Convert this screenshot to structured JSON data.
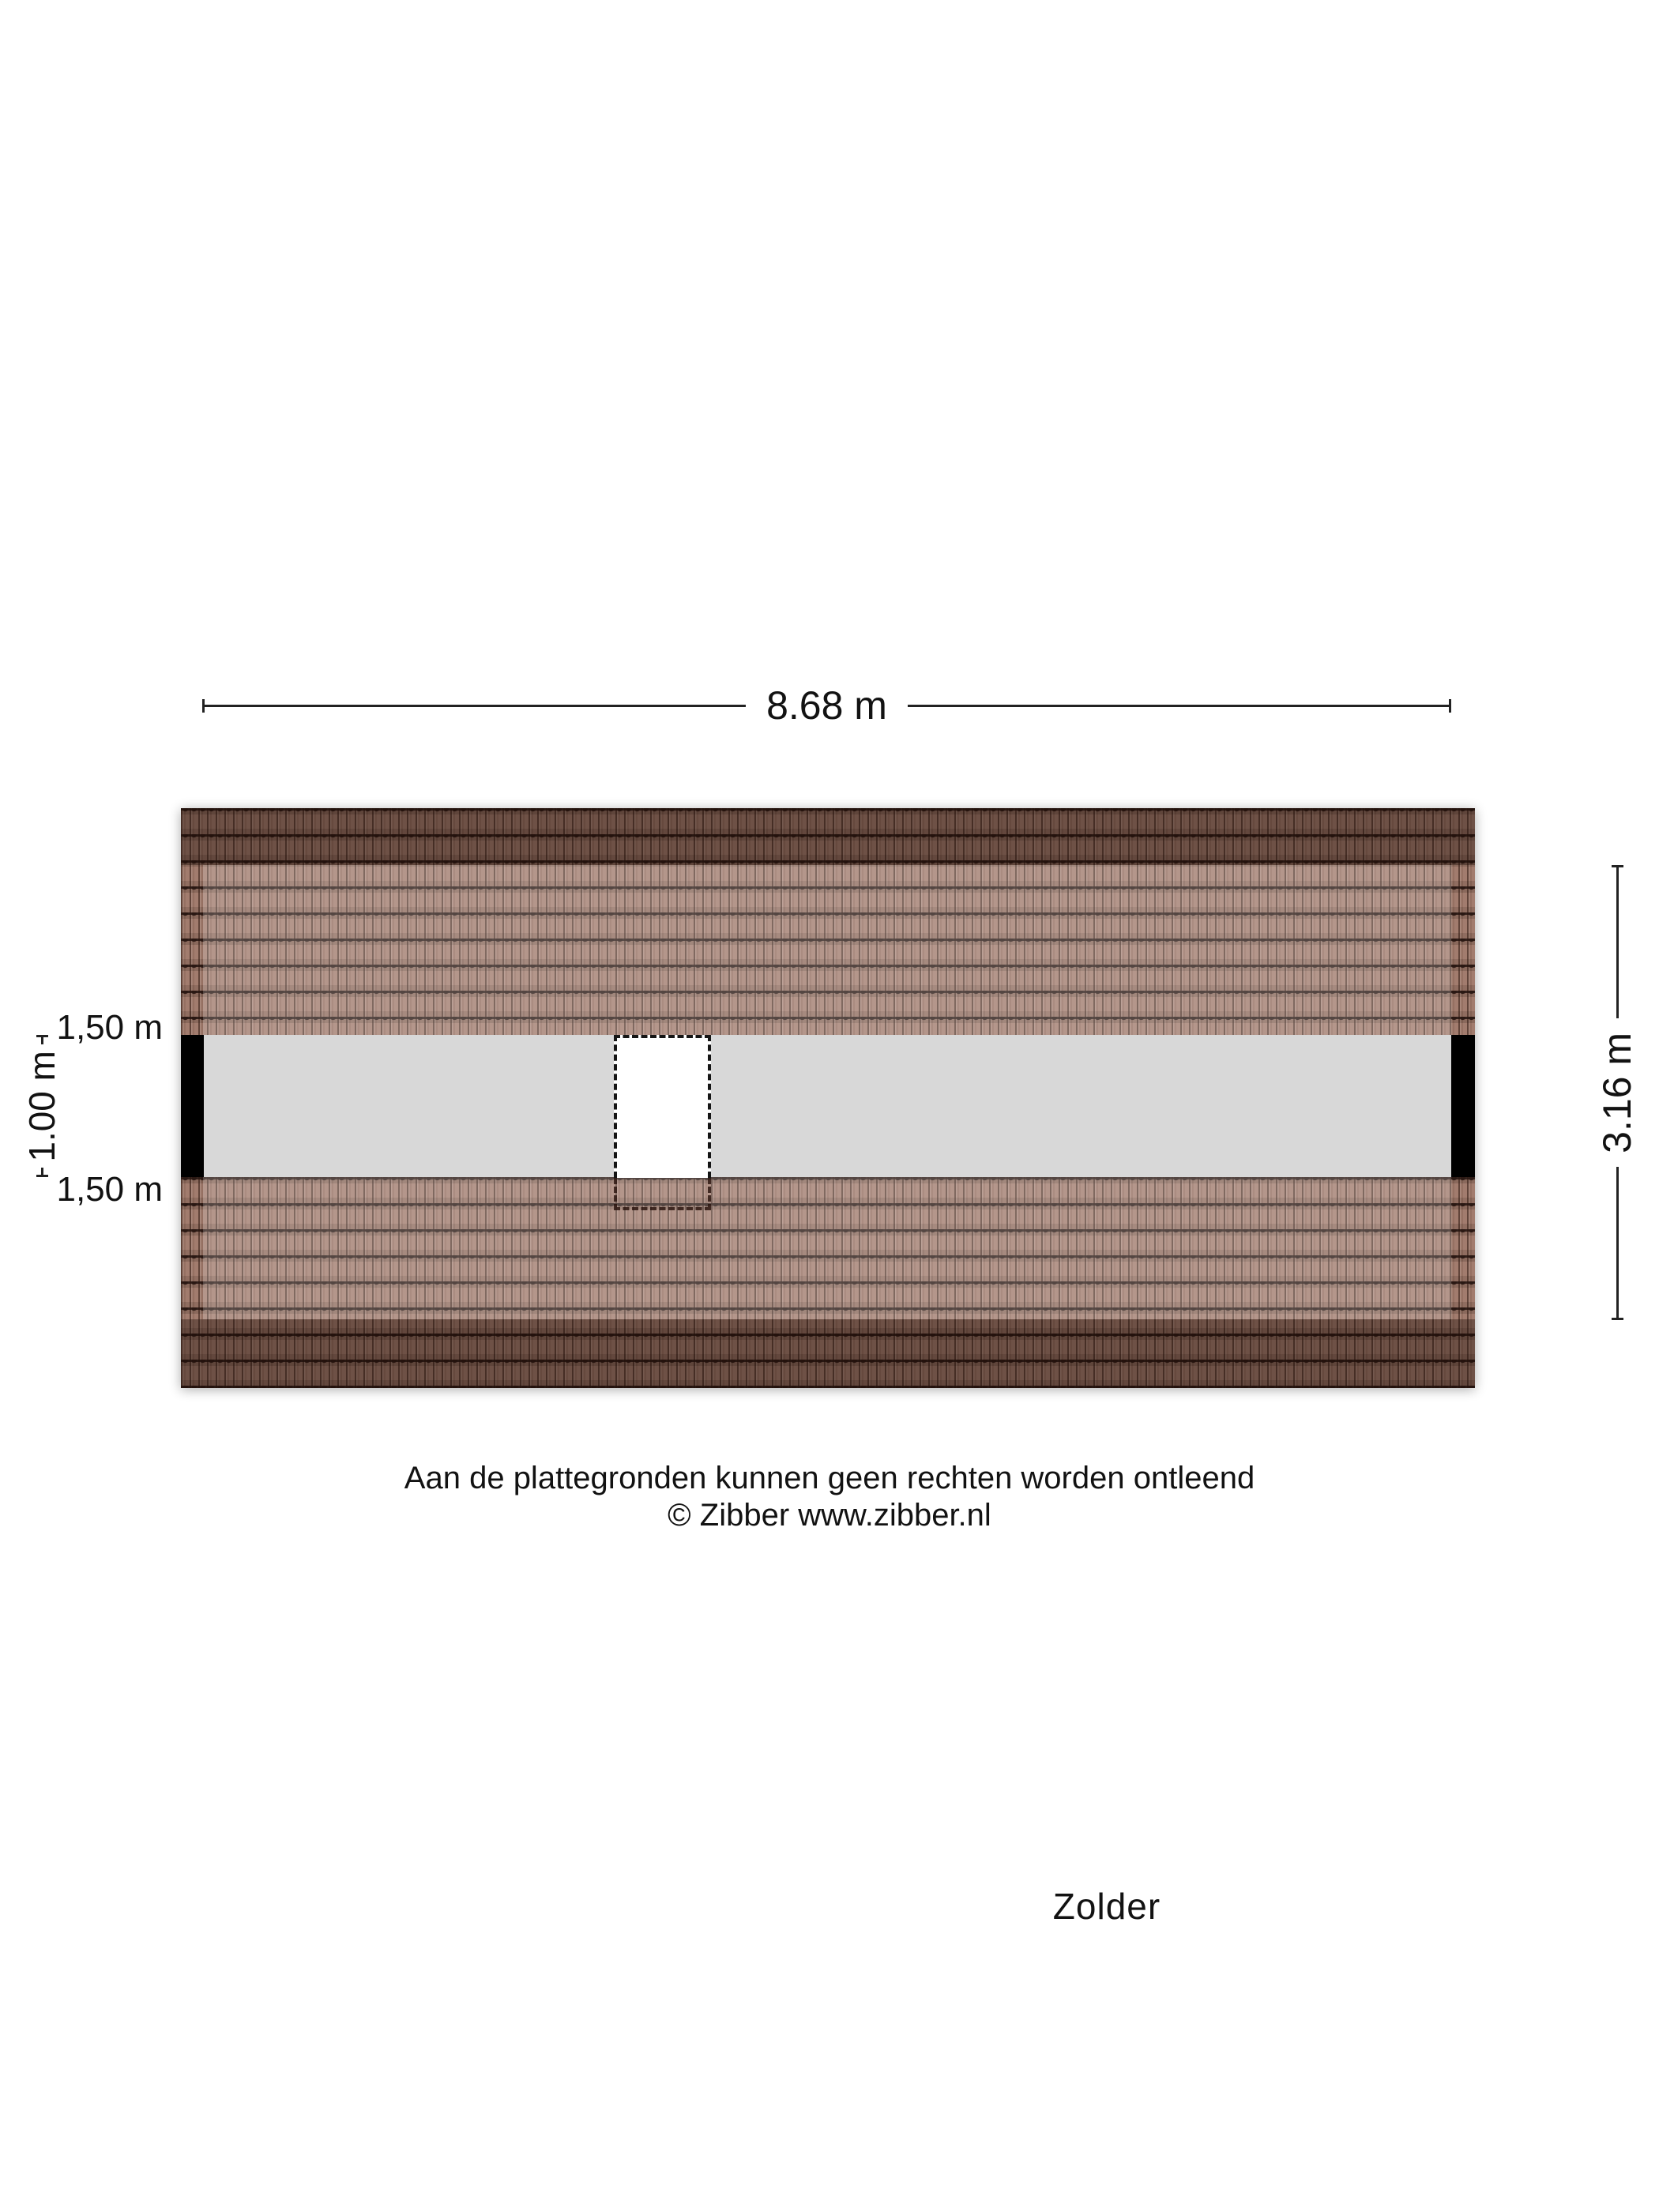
{
  "floorplan": {
    "room_label": "Zolder",
    "dimensions": {
      "top_width": "8.68 m",
      "right_height": "3.16 m",
      "left_floor_depth": "1.00 m",
      "left_roof_top": "1,50 m",
      "left_roof_bottom": "1,50 m"
    },
    "colors": {
      "tile_base": "#9b7363",
      "tile_line": "#2a1813",
      "roof_dark_band": "rgba(26,11,6,0.38)",
      "floor_gray": "#d8d8d8",
      "wall_black": "#000000",
      "dimension_line": "#222222"
    }
  },
  "footer": {
    "disclaimer": "Aan de plattegronden kunnen geen rechten worden ontleend",
    "copyright": "© Zibber www.zibber.nl"
  }
}
